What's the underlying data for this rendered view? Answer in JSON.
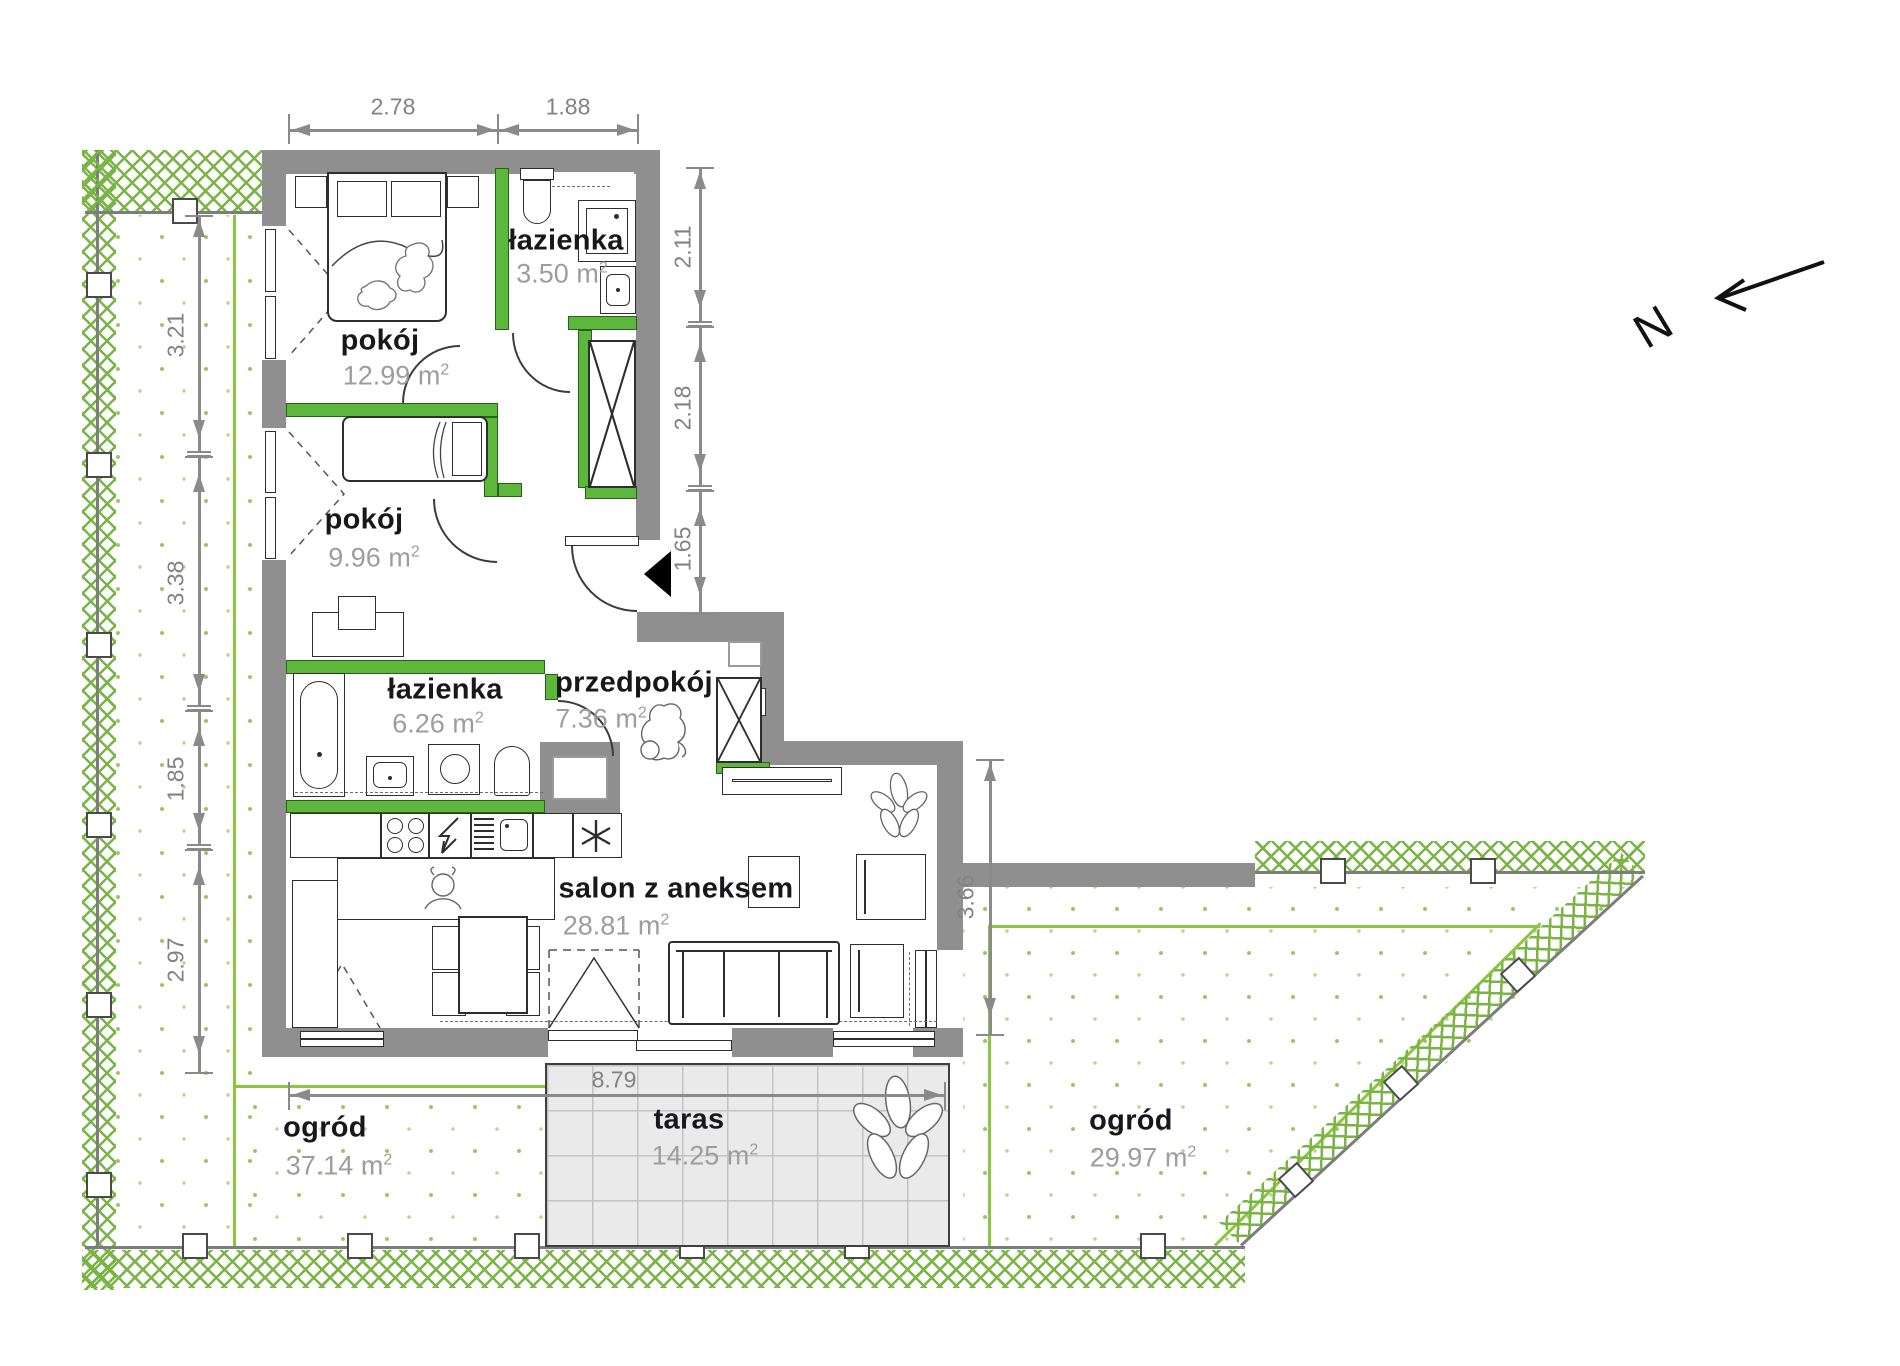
{
  "north": "N",
  "units": {
    "m": "m",
    "sup": "2"
  },
  "rooms": [
    {
      "name": "pokój",
      "area": "12.99"
    },
    {
      "name": "łazienka",
      "area": "3.50"
    },
    {
      "name": "pokój",
      "area": "9.96"
    },
    {
      "name": "łazienka",
      "area": "6.26"
    },
    {
      "name": "przedpokój",
      "area": "7.36"
    },
    {
      "name": "salon z aneksem",
      "area": "28.81"
    },
    {
      "name": "taras",
      "area": "14.25"
    },
    {
      "name": "ogród",
      "area": "37.14"
    },
    {
      "name": "ogród",
      "area": "29.97"
    }
  ],
  "dimensions": {
    "top": [
      "2.78",
      "1.88"
    ],
    "left": [
      "3.21",
      "3.38",
      "1.85",
      "2.97"
    ],
    "right": [
      "2.11",
      "2.18",
      "1.65"
    ],
    "salon_right": "3.66",
    "terrace_width": "8.79"
  },
  "colors": {
    "wall": "#8f8f8f",
    "partition_wall": "#5eb73d",
    "garden_boundary": "#8cc63e",
    "fence_hatch": "#79b544",
    "terrace_fill": "#eaeaea",
    "room_name_text": "#17171c",
    "area_text": "#9d9d9d",
    "dimension_text": "#828282"
  }
}
